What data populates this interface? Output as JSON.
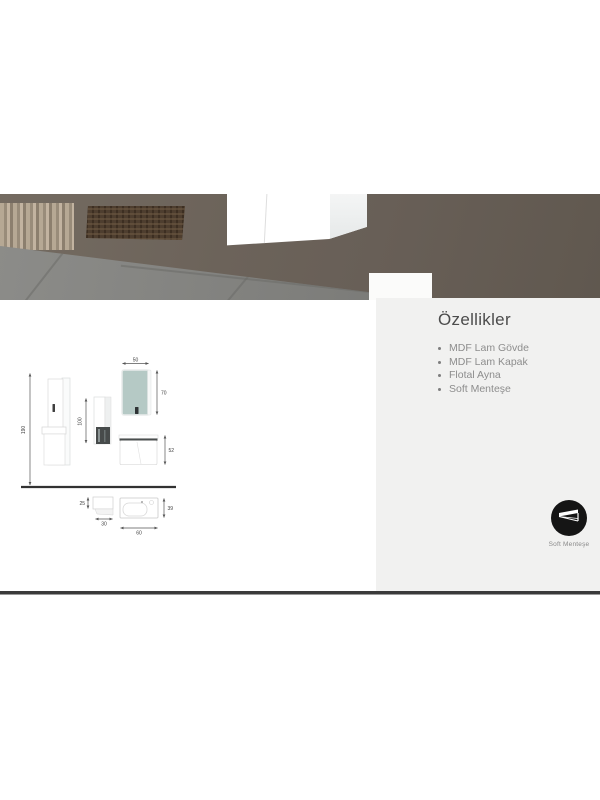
{
  "panel": {
    "title": "Özellikler",
    "features": [
      "MDF Lam Gövde",
      "MDF Lam Kapak",
      "Flotal Ayna",
      "Soft Menteşe"
    ],
    "bg_color": "#f1f1f0",
    "title_color": "#4c4c4c",
    "text_color": "#8d8d8d"
  },
  "badge": {
    "label": "Soft Menteşe",
    "icon": "soft-close-hinge-icon",
    "circle_color": "#151515"
  },
  "drawing": {
    "dims": {
      "total_height": "190",
      "column_height": "100",
      "mirror_width": "50",
      "mirror_height": "70",
      "cabinet_height": "52",
      "side_box_depth": "25",
      "side_box_width": "30",
      "basin_width": "60",
      "basin_depth": "39"
    },
    "mirror_color": "#b5c9c5"
  },
  "photo": {
    "wall_color": "#6c635a",
    "floor_color": "#7e7e7b",
    "curtain_color": "#b6a894",
    "basket_color": "#4e3e2f",
    "cabinet_color": "#ffffff"
  },
  "divider_color": "#3a3a3a"
}
